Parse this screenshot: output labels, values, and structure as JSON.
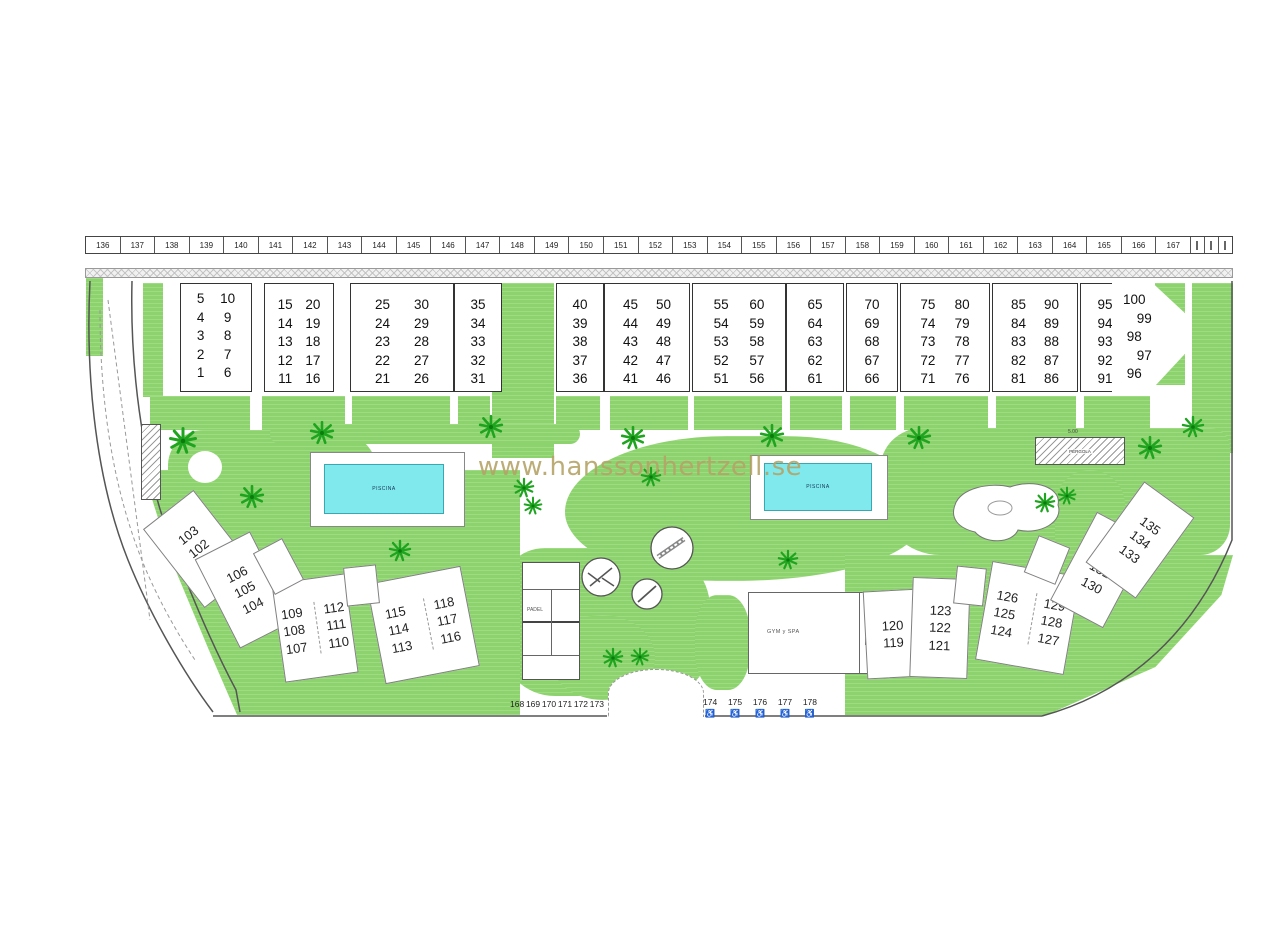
{
  "watermark": {
    "text": "www.hanssonhertzell.se"
  },
  "parking": {
    "spaces": [
      "136",
      "137",
      "138",
      "139",
      "140",
      "141",
      "142",
      "143",
      "144",
      "145",
      "146",
      "147",
      "148",
      "149",
      "150",
      "151",
      "152",
      "153",
      "154",
      "155",
      "156",
      "157",
      "158",
      "159",
      "160",
      "161",
      "162",
      "163",
      "164",
      "165",
      "166",
      "167"
    ]
  },
  "blocks": {
    "a": {
      "columns": [
        [
          "5",
          "4",
          "3",
          "2",
          "1"
        ],
        [
          "10",
          "9",
          "8",
          "7",
          "6"
        ]
      ]
    },
    "b1": {
      "columns": [
        [
          "15",
          "14",
          "13",
          "12",
          "11"
        ],
        [
          "20",
          "19",
          "18",
          "17",
          "16"
        ]
      ]
    },
    "b2": {
      "columns": [
        [
          "25",
          "24",
          "23",
          "22",
          "21"
        ],
        [
          "30",
          "29",
          "28",
          "27",
          "26"
        ]
      ]
    },
    "b3": {
      "columns": [
        [
          "35",
          "34",
          "33",
          "32",
          "31"
        ]
      ]
    },
    "c1": {
      "columns": [
        [
          "40",
          "39",
          "38",
          "37",
          "36"
        ]
      ]
    },
    "c2": {
      "columns": [
        [
          "45",
          "44",
          "43",
          "42",
          "41"
        ],
        [
          "50",
          "49",
          "48",
          "47",
          "46"
        ]
      ]
    },
    "c3": {
      "columns": [
        [
          "55",
          "54",
          "53",
          "52",
          "51"
        ],
        [
          "60",
          "59",
          "58",
          "57",
          "56"
        ]
      ]
    },
    "c4": {
      "columns": [
        [
          "65",
          "64",
          "63",
          "62",
          "61"
        ]
      ]
    },
    "d1": {
      "columns": [
        [
          "70",
          "69",
          "68",
          "67",
          "66"
        ]
      ]
    },
    "d2": {
      "columns": [
        [
          "75",
          "74",
          "73",
          "72",
          "71"
        ],
        [
          "80",
          "79",
          "78",
          "77",
          "76"
        ]
      ]
    },
    "d3": {
      "columns": [
        [
          "85",
          "84",
          "83",
          "82",
          "81"
        ],
        [
          "90",
          "89",
          "88",
          "87",
          "86"
        ]
      ]
    },
    "d4": {
      "columns": [
        [
          "95",
          "94",
          "93",
          "92",
          "91"
        ]
      ]
    },
    "e": {
      "columns": [
        [
          "100",
          "99",
          "98",
          "97",
          "96"
        ]
      ]
    }
  },
  "pools": {
    "left": "PISCINA",
    "right": "PISCINA"
  },
  "pergola": {
    "label": "PÉRGOLA",
    "dimension": "5.00"
  },
  "facilities": {
    "padel": "PADEL",
    "gym": "GYM y SPA"
  },
  "cluster_left": [
    {
      "units": [
        "103",
        "102",
        "101"
      ]
    },
    {
      "units": [
        "106",
        "105",
        "104"
      ]
    },
    {
      "units": [
        "109",
        "108",
        "107"
      ]
    },
    {
      "units": [
        "112",
        "111",
        "110"
      ]
    },
    {
      "units": [
        "115",
        "114",
        "113"
      ]
    },
    {
      "units": [
        "118",
        "117",
        "116"
      ]
    }
  ],
  "cluster_right": [
    {
      "units": [
        "120",
        "119"
      ]
    },
    {
      "units": [
        "123",
        "122",
        "121"
      ]
    },
    {
      "units": [
        "126",
        "125",
        "124"
      ]
    },
    {
      "units": [
        "129",
        "128",
        "127"
      ]
    },
    {
      "units": [
        "132",
        "131",
        "130"
      ]
    },
    {
      "units": [
        "135",
        "134",
        "133"
      ]
    }
  ],
  "bottom": {
    "left_spaces": [
      "168",
      "169",
      "170",
      "171",
      "172",
      "173"
    ],
    "accessible_spaces": [
      "174",
      "175",
      "176",
      "177",
      "178"
    ],
    "accessible_icon": "♿"
  },
  "colors": {
    "grass": "#8dd36d",
    "pool": "#80e9ed",
    "watermark": "#b5a468"
  }
}
